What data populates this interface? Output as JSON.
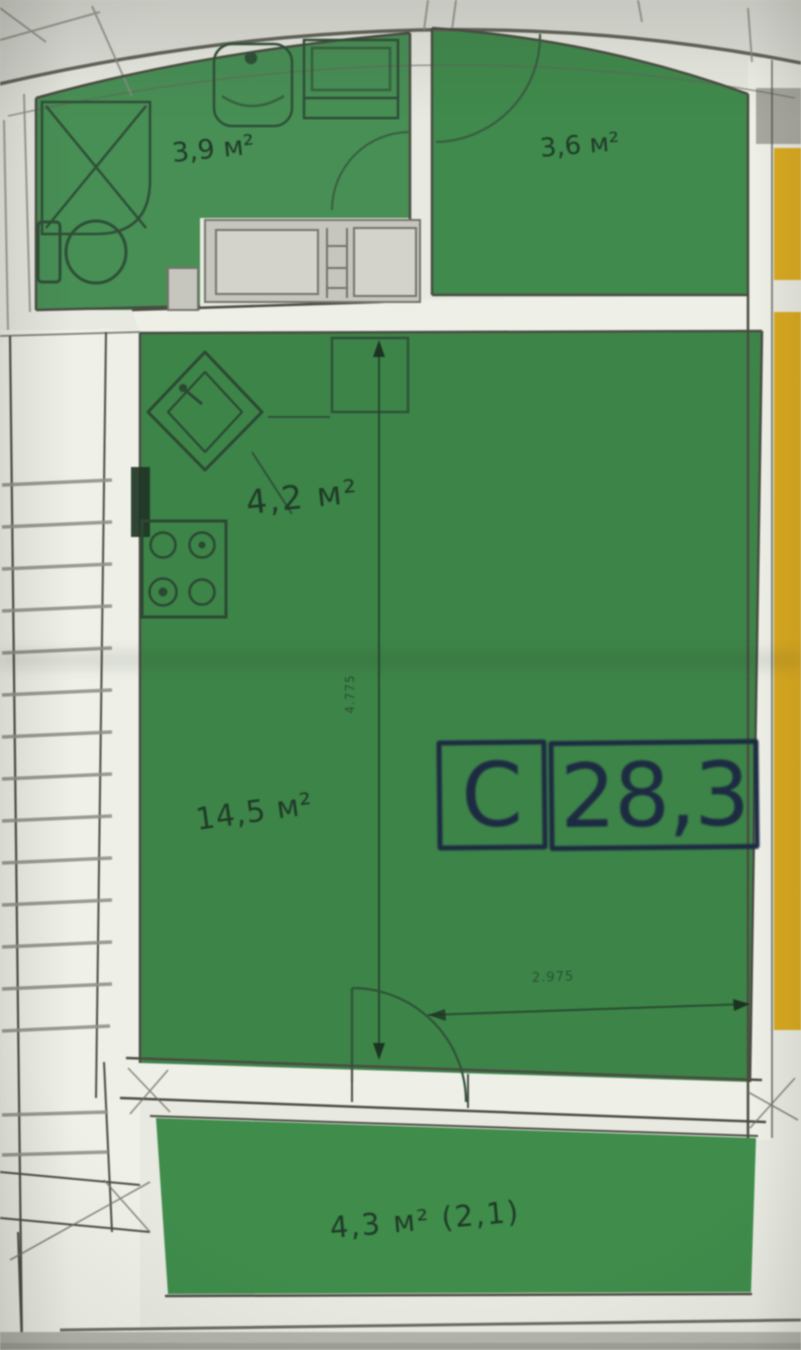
{
  "plan": {
    "unit_badge": {
      "type_letter": "С",
      "area_value": "28,3"
    },
    "rooms": [
      {
        "id": "bathroom",
        "area_label": "3,9 м²"
      },
      {
        "id": "entrance-hall",
        "area_label": "3,6 м²"
      },
      {
        "id": "kitchen-zone",
        "area_label": "4,2 м²"
      },
      {
        "id": "living-zone",
        "area_label": "14,5 м²"
      },
      {
        "id": "balcony",
        "area_label": "4,3 м² (2,1)"
      }
    ],
    "dimensions": {
      "vertical_label": "4.775",
      "horizontal_label": "2.975"
    },
    "colors": {
      "room_fill": "#3f8749",
      "bathroom_fill": "#478f55",
      "balcony_fill": "#3f8c4b",
      "neighbor_fill": "#d9a91f",
      "wall_fill": "#eef0e8",
      "line": "#4a4c42",
      "badge": "#1d2b42",
      "furniture": "#c9c9c1",
      "photo_bg": "#e8e9e1"
    }
  }
}
